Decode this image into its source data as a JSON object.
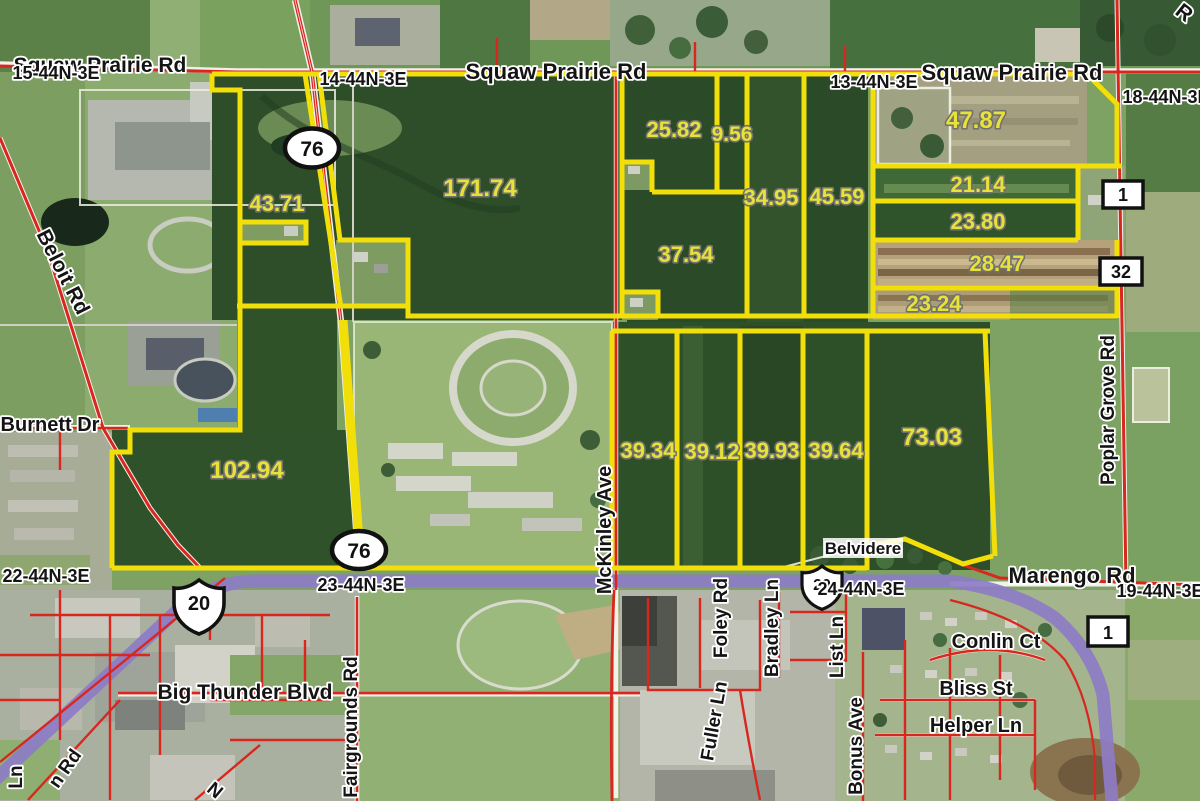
{
  "map": {
    "parcels": [
      {
        "acres": "43.71"
      },
      {
        "acres": "171.74"
      },
      {
        "acres": "25.82"
      },
      {
        "acres": "9.56"
      },
      {
        "acres": "34.95"
      },
      {
        "acres": "45.59"
      },
      {
        "acres": "47.87"
      },
      {
        "acres": "21.14"
      },
      {
        "acres": "23.80"
      },
      {
        "acres": "28.47"
      },
      {
        "acres": "23.24"
      },
      {
        "acres": "37.54"
      },
      {
        "acres": "39.34"
      },
      {
        "acres": "39.12"
      },
      {
        "acres": "39.93"
      },
      {
        "acres": "39.64"
      },
      {
        "acres": "73.03"
      },
      {
        "acres": "102.94"
      }
    ],
    "roads": {
      "squaw_prairie": "Squaw Prairie Rd",
      "beloit": "Beloit Rd",
      "burnett": "Burnett Dr",
      "big_thunder": "Big Thunder Blvd",
      "fairgrounds": "Fairgrounds Rd",
      "mckinley": "McKinley Ave",
      "foley": "Foley Rd",
      "fuller": "Fuller Ln",
      "bradley": "Bradley Ln",
      "list": "List Ln",
      "bonus": "Bonus Ave",
      "marengo": "Marengo Rd",
      "poplar_grove": "Poplar Grove Rd",
      "conlin": "Conlin Ct",
      "bliss": "Bliss St",
      "helper": "Helper Ln",
      "ln_fragment": "Ln",
      "n_rd_fragment": "n Rd",
      "n_fragment": "N",
      "r_fragment": "R"
    },
    "sections": {
      "s15": "15-44N-3E",
      "s14": "14-44N-3E",
      "s13": "13-44N-3E",
      "s18": "18-44N-3E",
      "s22": "22-44N-3E",
      "s23": "23-44N-3E",
      "s24": "24-44N-3E",
      "s19": "19-44N-3E"
    },
    "shields": {
      "il76": "76",
      "us20": "20",
      "marker1": "1",
      "marker32": "32"
    },
    "places": {
      "belvidere": "Belvidere"
    },
    "colors": {
      "parcel_line": "#f2df0a",
      "parcel_label": "#e7e23b",
      "us20_highlight": "#8d7cc6",
      "road_red": "#d8271e"
    }
  }
}
